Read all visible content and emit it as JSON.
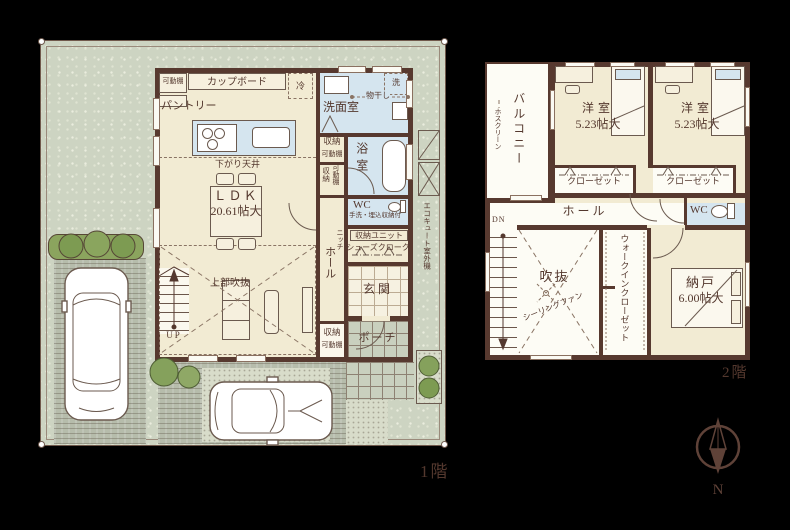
{
  "floor1": {
    "caption": "1階",
    "labels": {
      "movable_shelf": "可動棚",
      "cupboard": "カップボード",
      "fridge": "冷",
      "pantry": "パントリー",
      "washroom": "洗面室",
      "laundry_pole": "物干し",
      "washer": "洗",
      "storage": "収納",
      "bathroom": "浴室",
      "lowered_ceiling": "下がり天井",
      "ldk_name": "ＬＤＫ",
      "ldk_size": "20.61帖大",
      "wc": "WC",
      "wc_note": "手洗・埋込収納付",
      "niche": "ニッチ",
      "hall": "ホール",
      "storage_unit": "収納ユニット",
      "shoes_cloak": "シューズクローク",
      "entrance": "玄関",
      "porch": "ポーチ",
      "open_above": "上部吹抜",
      "up": "UP",
      "ecocute": "エコキュート室外機"
    }
  },
  "floor2": {
    "caption": "2階",
    "labels": {
      "balcony": "バルコニー",
      "hoscreen": "ホスクリーン",
      "closet": "クローゼット",
      "hall": "ホール",
      "wc": "WC",
      "dn": "DN",
      "void": "吹抜",
      "ceiling_fan": "シーリングファン",
      "walk_in_closet": "ウォークインクローゼット",
      "storeroom_name": "納戸",
      "storeroom_size": "6.00帖大"
    },
    "rooms": [
      {
        "name": "洋室",
        "size": "5.23帖大"
      },
      {
        "name": "洋室",
        "size": "5.23帖大"
      }
    ]
  },
  "compass": {
    "north_label": "N"
  },
  "colors": {
    "background": "#000000",
    "wall": "#57392f",
    "floor_cream": "#f2ebd3",
    "water_blue": "#d5e5ef",
    "lawn_green": "#cdd4c2",
    "paving": "#b6bcab",
    "tree_green": "#85a15c",
    "text": "#54382e"
  }
}
